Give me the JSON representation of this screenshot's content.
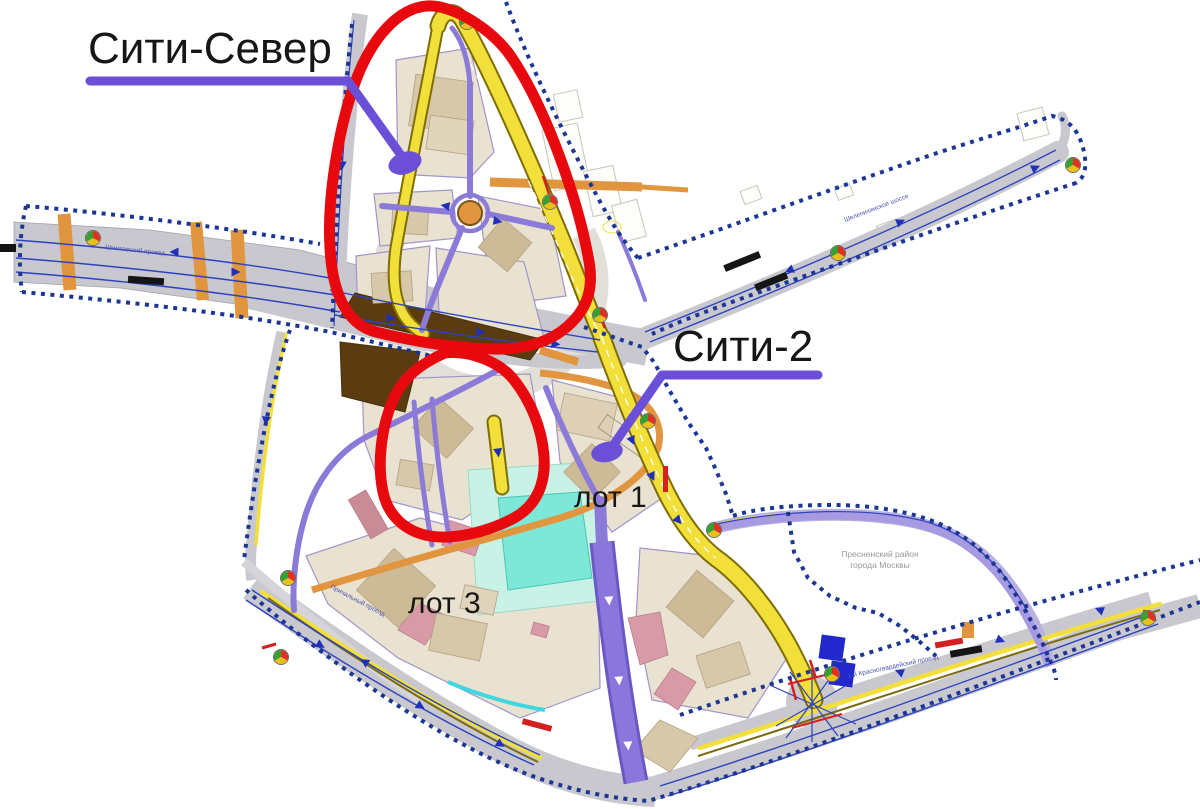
{
  "annotations": {
    "city_north": "Сити-Север",
    "city_2": "Сити-2",
    "lot_1": "лот 1",
    "lot_3": "лот 3"
  },
  "district_note": {
    "line1": "Пресненский район",
    "line2": "города Москвы"
  },
  "streets": {
    "west": "Шмитовский проезд",
    "northeast": "Шелепихинское шоссе",
    "southwest": "Причальный проезд",
    "southeast": "1-й Красногвардейский проезд"
  },
  "colors": {
    "annotation_red": "#e8090f",
    "annotation_purple": "#6b4fd6",
    "road_yellow": "#f2df3a",
    "road_gray": "#c8c8ce",
    "road_purple": "#8b7ad8",
    "road_orange": "#e2953f",
    "boundary_blue": "#1c3694",
    "parcel_tan": "#e9e2d0",
    "water_cyan": "#7de8d8",
    "traffic_light": [
      "#e03020",
      "#e8c018",
      "#38a030"
    ]
  }
}
